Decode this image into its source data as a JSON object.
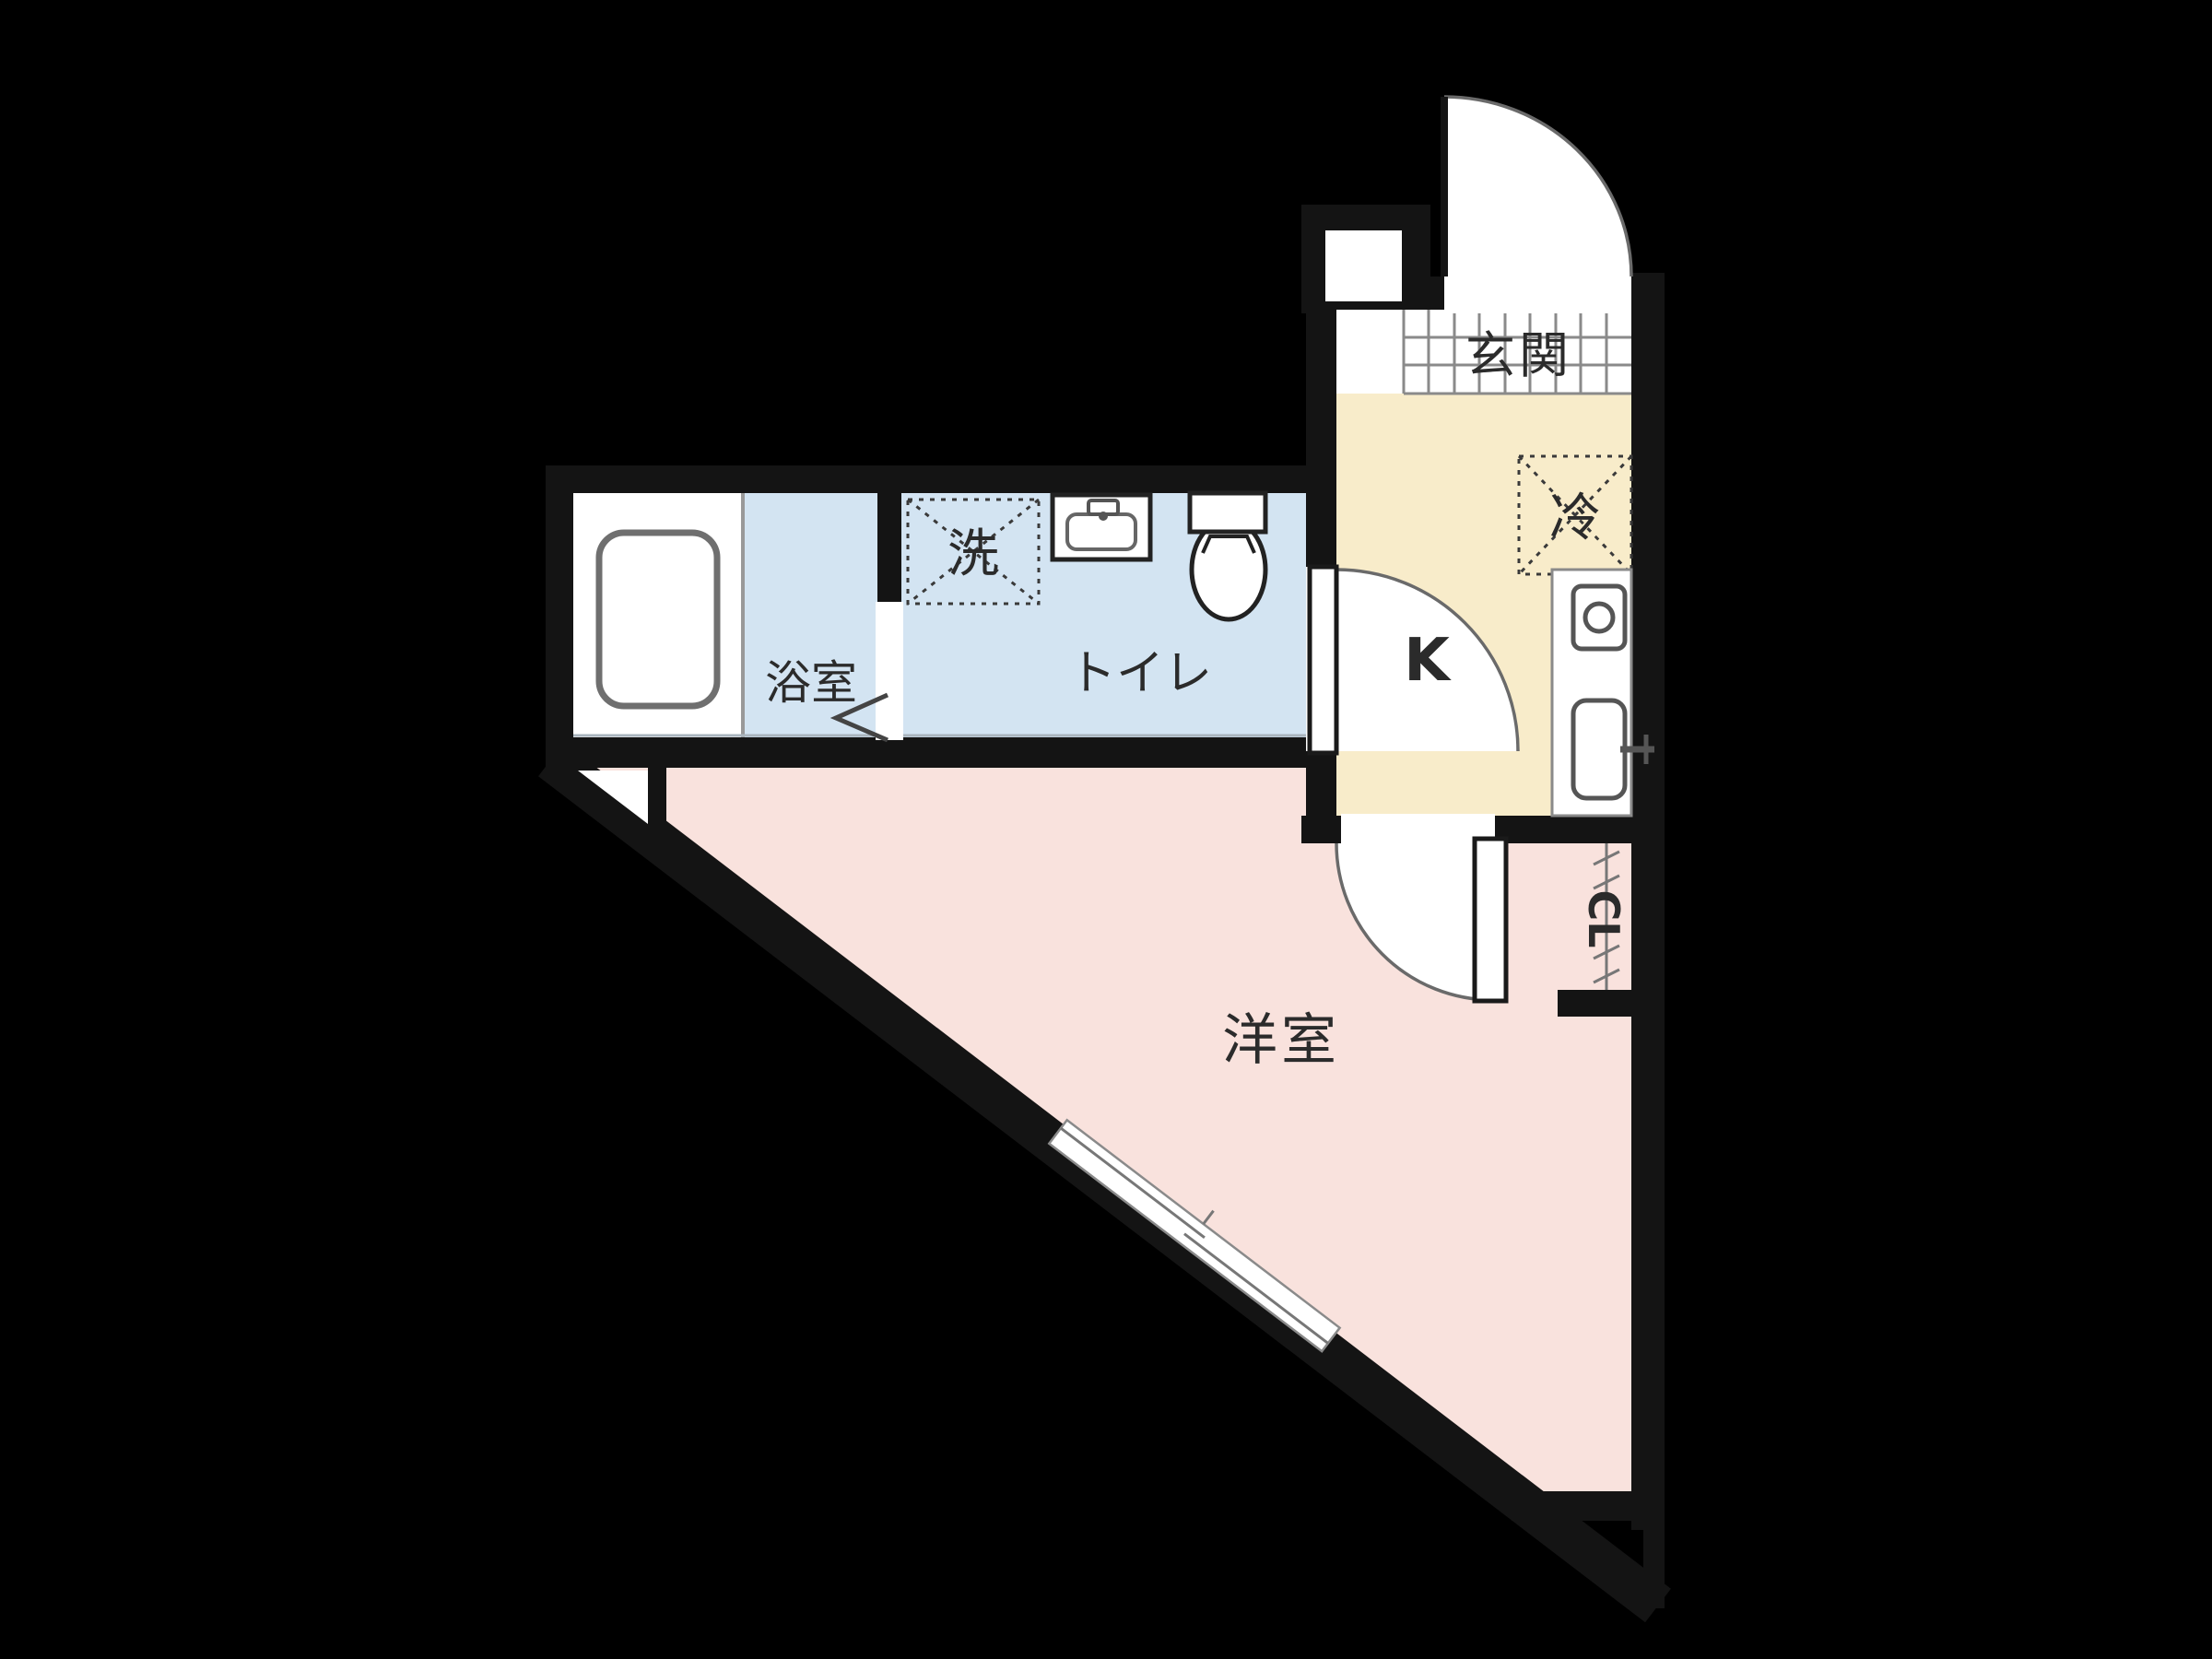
{
  "floorplan": {
    "title": "apartment-floor-plan",
    "rooms": {
      "genkan": {
        "label": "玄関"
      },
      "kitchen": {
        "label": "K"
      },
      "refrigerator": {
        "label": "冷"
      },
      "washer": {
        "label": "洗"
      },
      "bathroom": {
        "label": "浴室"
      },
      "toilet_room": {
        "label": "トイレ"
      },
      "western_room": {
        "label": "洋室"
      },
      "closet": {
        "label": "CL"
      }
    },
    "colors": {
      "background": "#000000",
      "wall": "#141414",
      "kitchen_floor": "#f8ecca",
      "wet_area_floor": "#d3e4f2",
      "main_room_floor": "#f9e2dd",
      "fixture_line": "#555555",
      "tile_line": "#8a8a8a"
    }
  }
}
